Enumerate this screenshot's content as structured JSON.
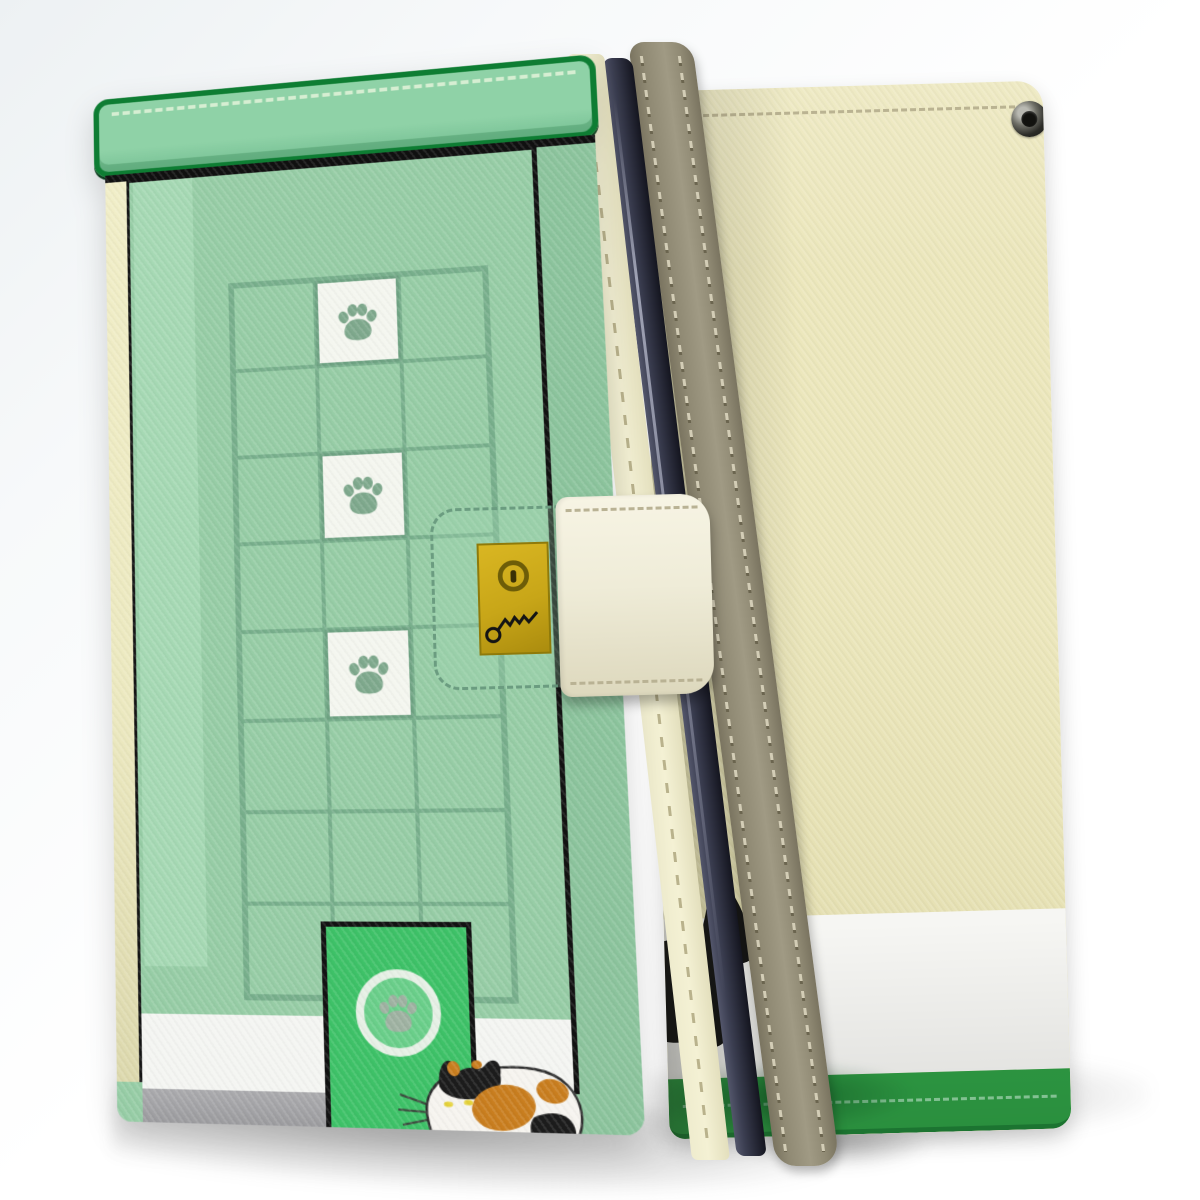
{
  "meta": {
    "subject": "Product photo of a wallet-style flip phone case, front and back views, cat and paw-print design",
    "front_label": "Front cover: mint green shop facade with paw-print window grid, gold keyhole clasp, cat door and calico cat",
    "back_label": "Back cover: cream leather with grommet, black cat walking on white band above green stitched hem"
  },
  "front_case": {
    "view": "front standing at angle",
    "grid": {
      "cols": 3,
      "rows": 8,
      "paw_tile_col": 1,
      "paw_tile_rows": [
        0,
        2,
        4
      ]
    },
    "parts": {
      "awning": "green stitched awning bar",
      "window_grid": "window pane grid with white paw tiles",
      "clasp_strap": "cream magnetic strap with dashed stitching",
      "lock_plate": "gold plate with keyhole and doodled key",
      "cat_door": "bright green cat door with paw emblem",
      "cat": "calico cat crouching on gray step",
      "hem": "green stitched hem"
    }
  },
  "back_case": {
    "view": "back standing at angle",
    "parts": {
      "stitch_line": "horizontal stitching near top",
      "grommet": "metal strap eyelet, top right",
      "cat": "black cat walking right, tail tip peeking past spine",
      "white_band": "white lower band",
      "hem": "green stitched hem"
    }
  },
  "spine": {
    "parts": {
      "strip": "khaki stitched spine",
      "phone_edge": "dark phone edge visible"
    }
  },
  "colors": {
    "bgTint": "#edf1f3",
    "awning": "#8fd2a7",
    "awningBorder": "#0e7d33",
    "awningStitch": "#d6eed2",
    "facade": "#97cda6",
    "facadeLight": "#a8dab6",
    "facadeDark": "#8cc49d",
    "gridLine": "#78af8c",
    "tileWhite": "#f4f6ef",
    "tileBorder": "#6fa383",
    "pawGreen": "#7fa98d",
    "creamStrip": "#f1eec8",
    "doorGreen": "#3ec268",
    "doorRing": "#e6f0e5",
    "doorPaw": "#9fb2a2",
    "skirtWhite": "#f4f5f2",
    "stepGray": "#9d9da0",
    "hemGreen": "#259740",
    "hemStitch": "#0f6326",
    "hemShade": "#187230",
    "edgeCream": "#efecce",
    "edgeStitch": "#b9b28c",
    "phoneNavy": "#3c3f52",
    "phoneNavyDark": "#14151f",
    "spineKhaki": "#908a74",
    "spineKhakiDark": "#7a7460",
    "spineStitchLight": "#d3cdb6",
    "spineStitchDark": "#6b654f",
    "strapCream": "#efecd8",
    "strapCreamDark": "#ddd8bd",
    "strapStitch": "#b9b294",
    "strapPrintLine": "#6b9c80",
    "goldPlate": "#c8a618",
    "goldPlateDark": "#8f7a0a",
    "keyholeDark": "#6d5d08",
    "backCream": "#ece7bc",
    "backCreamDark": "#e0dbac",
    "backStitch": "#b2aa85",
    "backWhite": "#f6f6f3",
    "backHem": "#2f9f45",
    "backHemStitch": "#8fd3a0",
    "backHemShade": "#1f8136",
    "grommetDark": "#2b2b27",
    "grommetLight": "#b9b9b2",
    "catBlack": "#141414",
    "catEye": "#d8e22a",
    "calicoWhite": "#f6f4ef",
    "calicoOrange": "#c97e1f",
    "calicoBlack": "#1c1c1c",
    "calicoEye": "#e5d23a",
    "calicoOutline": "#2e2e2e",
    "whisker": "#3c4a3e"
  }
}
